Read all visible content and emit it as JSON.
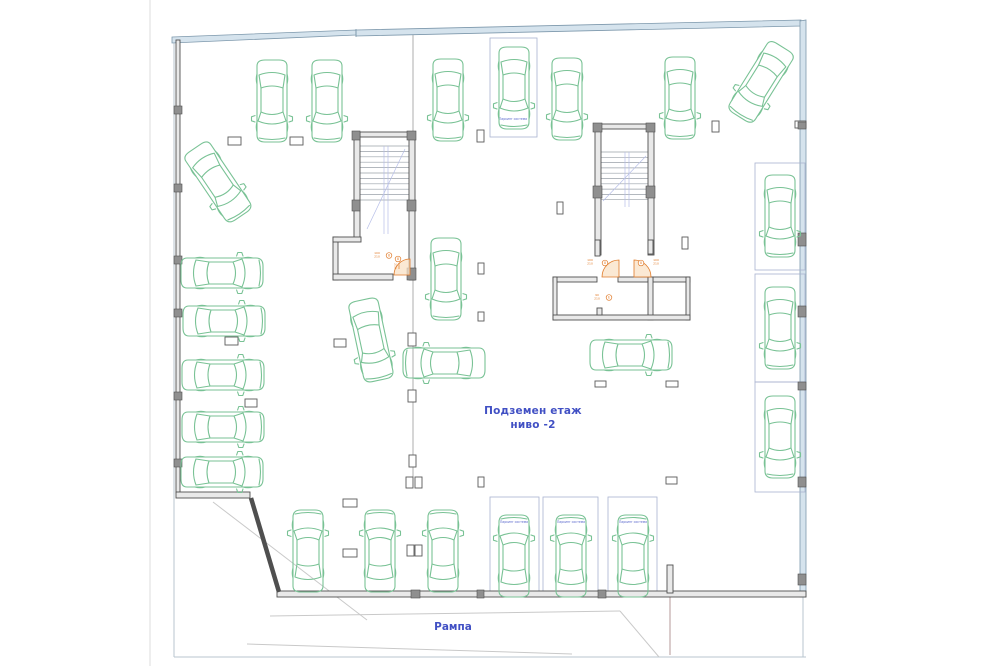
{
  "labels": {
    "title_line1": "Подземен етаж",
    "title_line2": "ниво -2",
    "ramp": "Рампа",
    "parking_system": "Паркинг система"
  },
  "colors": {
    "car": "#79c295",
    "wall_stroke": "#4f4f4f",
    "wall_fill": "#e9e9e9",
    "band_fill": "#d5e3ed",
    "band_stroke": "#7d98ac",
    "box_stroke": "#a9b2cf",
    "blue_text": "#4150c4",
    "tiny_blue": "#5866cc",
    "orange": "#e07a28",
    "arc_fill": "#f9e2c6",
    "tread": "#9aa0a8",
    "blue_detail": "#b6bee8",
    "thin": "#9a9a9a",
    "frame": "#b9c6cf",
    "page_edge": "#dcdcdc",
    "faint": "#c9c9c9",
    "reddish": "#b49a9a",
    "column_stroke": "#5a5a5a",
    "pilaster_fill": "#8f8f8f"
  },
  "frame": {
    "bands": [
      "172,37 356,30 356,35 172,43",
      "356,30 801,20 801,26 356,36",
      "800,21 806,20 806,597 800,597"
    ],
    "divider": [
      356,
      29,
      356,
      37
    ]
  },
  "walls": [
    [
      176,
      40,
      4,
      453
    ],
    [
      176,
      492,
      74,
      6
    ],
    [
      277,
      591,
      529,
      6
    ],
    [
      667,
      565,
      6,
      28
    ],
    [
      354,
      132,
      61,
      5
    ],
    [
      354,
      132,
      6,
      108
    ],
    [
      409,
      132,
      6,
      148
    ],
    [
      333,
      237,
      5,
      43
    ],
    [
      333,
      237,
      28,
      5
    ],
    [
      333,
      274,
      60,
      6
    ],
    [
      595,
      124,
      59,
      5
    ],
    [
      595,
      124,
      6,
      131
    ],
    [
      648,
      124,
      6,
      131
    ],
    [
      595,
      240,
      5,
      16
    ],
    [
      648,
      240,
      5,
      14
    ],
    [
      553,
      277,
      44,
      5
    ],
    [
      618,
      277,
      30,
      5
    ],
    [
      653,
      277,
      37,
      5
    ],
    [
      553,
      277,
      4,
      43
    ],
    [
      686,
      277,
      4,
      43
    ],
    [
      648,
      277,
      5,
      43
    ],
    [
      553,
      315,
      137,
      5
    ],
    [
      597,
      308,
      5,
      7
    ]
  ],
  "diag_wall": [
    251,
    498,
    279,
    592
  ],
  "thin_lines": [
    [
      150,
      0,
      150,
      666,
      "page_edge"
    ],
    [
      174,
      40,
      174,
      657,
      "frame"
    ],
    [
      174,
      657,
      806,
      657,
      "frame"
    ],
    [
      803,
      597,
      803,
      657,
      "frame"
    ],
    [
      413,
      31,
      413,
      132,
      "thin"
    ],
    [
      413,
      280,
      413,
      477,
      "thin"
    ],
    [
      670,
      597,
      670,
      655,
      "reddish"
    ],
    [
      213,
      502,
      367,
      620,
      "faint"
    ],
    [
      270,
      616,
      620,
      611,
      "faint"
    ],
    [
      247,
      644,
      572,
      654,
      "faint"
    ],
    [
      620,
      611,
      659,
      657,
      "faint"
    ]
  ],
  "stairs": [
    {
      "treads": [
        359,
        409,
        146,
        5.4,
        11
      ],
      "blue": [
        [
          384,
          146,
          384,
          234
        ],
        [
          388,
          146,
          388,
          234
        ],
        [
          405,
          149,
          367,
          229
        ]
      ]
    },
    {
      "treads": [
        601,
        648,
        152,
        5.3,
        10
      ],
      "blue": [
        [
          625,
          152,
          625,
          207
        ],
        [
          629,
          152,
          629,
          207
        ],
        [
          646,
          156,
          603,
          201
        ]
      ]
    }
  ],
  "columns": [
    [
      228,
      137,
      13,
      8
    ],
    [
      290,
      137,
      13,
      8
    ],
    [
      477,
      130,
      7,
      12
    ],
    [
      712,
      121,
      7,
      11
    ],
    [
      795,
      121,
      11,
      7
    ],
    [
      557,
      202,
      6,
      12
    ],
    [
      682,
      237,
      6,
      12
    ],
    [
      478,
      263,
      6,
      11
    ],
    [
      478,
      312,
      6,
      9
    ],
    [
      225,
      337,
      13,
      8
    ],
    [
      334,
      339,
      12,
      8
    ],
    [
      408,
      333,
      8,
      13
    ],
    [
      595,
      381,
      11,
      6
    ],
    [
      666,
      381,
      12,
      6
    ],
    [
      245,
      399,
      12,
      8
    ],
    [
      408,
      390,
      8,
      12
    ],
    [
      409,
      455,
      7,
      12
    ],
    [
      406,
      477,
      7,
      11
    ],
    [
      415,
      477,
      7,
      11
    ],
    [
      478,
      477,
      6,
      10
    ],
    [
      666,
      477,
      11,
      7
    ],
    [
      343,
      499,
      14,
      8
    ],
    [
      343,
      549,
      14,
      8
    ],
    [
      407,
      545,
      7,
      11
    ],
    [
      415,
      545,
      7,
      11
    ]
  ],
  "pilasters": [
    [
      174,
      106,
      8,
      8
    ],
    [
      174,
      184,
      8,
      8
    ],
    [
      174,
      256,
      8,
      8
    ],
    [
      174,
      309,
      8,
      8
    ],
    [
      174,
      392,
      8,
      8
    ],
    [
      174,
      459,
      8,
      8
    ],
    [
      798,
      122,
      8,
      7
    ],
    [
      798,
      233,
      8,
      13
    ],
    [
      798,
      306,
      8,
      11
    ],
    [
      798,
      382,
      8,
      8
    ],
    [
      798,
      477,
      8,
      10
    ],
    [
      798,
      574,
      8,
      11
    ],
    [
      352,
      131,
      8,
      9
    ],
    [
      352,
      200,
      8,
      11
    ],
    [
      407,
      131,
      9,
      9
    ],
    [
      407,
      200,
      9,
      11
    ],
    [
      407,
      268,
      9,
      12
    ],
    [
      593,
      123,
      9,
      9
    ],
    [
      593,
      186,
      9,
      12
    ],
    [
      646,
      123,
      9,
      9
    ],
    [
      646,
      186,
      9,
      12
    ],
    [
      411,
      590,
      9,
      8
    ],
    [
      477,
      590,
      7,
      8
    ],
    [
      598,
      590,
      8,
      8
    ]
  ],
  "boxes": [
    [
      490,
      38,
      47,
      99
    ],
    [
      755,
      163,
      50,
      107
    ],
    [
      755,
      274,
      50,
      108
    ],
    [
      755,
      382,
      50,
      110
    ],
    [
      490,
      497,
      49,
      97
    ],
    [
      543,
      497,
      55,
      97
    ],
    [
      608,
      497,
      49,
      97
    ]
  ],
  "box_labels": [
    [
      513,
      120
    ],
    [
      514,
      523
    ],
    [
      571,
      523
    ],
    [
      633,
      523
    ]
  ],
  "door_arcs": [
    "M394,275 A16,16 0 0 1 410,259 L410,275 Z",
    "M602,277 A17,17 0 0 1 619,260 L619,277 Z",
    "M651,277 A17,17 0 0 0 634,260 L634,277 Z"
  ],
  "door_labels": [
    {
      "x": 377,
      "y": 254,
      "lines": [
        "100",
        "210"
      ],
      "cx": 389,
      "cy": 255.5,
      "glyph": "8",
      "rot": 0
    },
    {
      "x": 398,
      "y": 266,
      "lines": [
        "100",
        "210"
      ],
      "cx": 398,
      "cy": 259,
      "glyph": "8",
      "rot": 90
    },
    {
      "x": 590,
      "y": 261,
      "lines": [
        "100",
        "210"
      ],
      "cx": 605,
      "cy": 263,
      "glyph": "8",
      "rot": 0
    },
    {
      "x": 656,
      "y": 261,
      "lines": [
        "100",
        "210"
      ],
      "cx": 641,
      "cy": 263,
      "glyph": "8",
      "rot": 0
    },
    {
      "x": 597,
      "y": 296,
      "lines": [
        "90",
        "210"
      ],
      "cx": 609,
      "cy": 297.5,
      "glyph": "Е",
      "rot": 0
    }
  ],
  "cars": [
    [
      272,
      101,
      180
    ],
    [
      327,
      101,
      180
    ],
    [
      448,
      100,
      180
    ],
    [
      514,
      88,
      180
    ],
    [
      567,
      99,
      180
    ],
    [
      680,
      98,
      180
    ],
    [
      761,
      82,
      212
    ],
    [
      218,
      182,
      146
    ],
    [
      222,
      273,
      90
    ],
    [
      224,
      321,
      90
    ],
    [
      223,
      375,
      90
    ],
    [
      223,
      427,
      90
    ],
    [
      222,
      472,
      90
    ],
    [
      446,
      279,
      180
    ],
    [
      371,
      340,
      168
    ],
    [
      444,
      363,
      -90
    ],
    [
      631,
      355,
      90
    ],
    [
      780,
      216,
      180
    ],
    [
      780,
      328,
      180
    ],
    [
      780,
      437,
      180
    ],
    [
      308,
      551,
      0
    ],
    [
      380,
      551,
      0
    ],
    [
      443,
      551,
      0
    ],
    [
      514,
      556,
      0
    ],
    [
      571,
      556,
      0
    ],
    [
      633,
      556,
      0
    ]
  ]
}
